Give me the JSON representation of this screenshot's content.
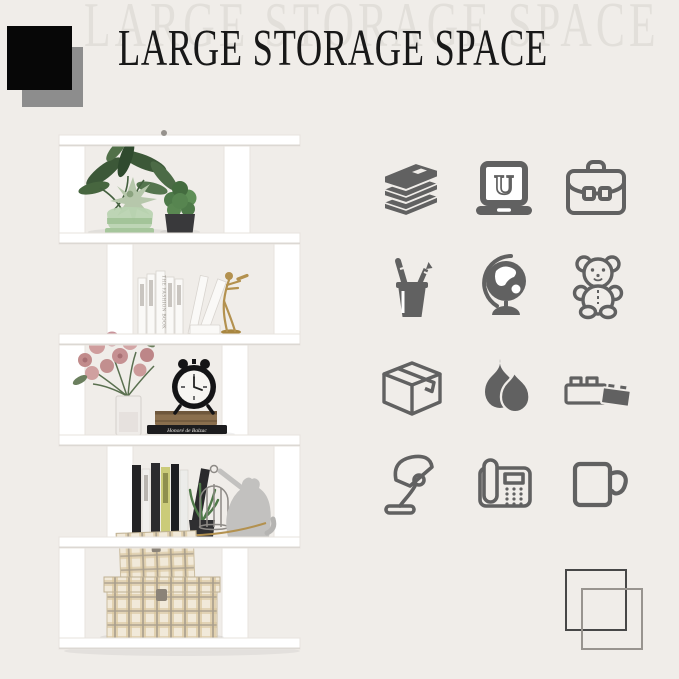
{
  "page": {
    "width": 679,
    "height": 679,
    "background": "#f0ede9"
  },
  "header": {
    "echo_title": "LARGE STORAGE SPACE",
    "title": "LARGE STORAGE SPACE",
    "title_color": "#181818",
    "echo_color": "#e2dfda",
    "black_square_color": "#070707",
    "gray_square_color": "#8d8d8d"
  },
  "photo": {
    "alt": "White 5-tier S-shaped geometric bookcase decorated with plants, white books, a gold violinist figurine, a rose bouquet, an alarm clock on stacked books, a cat figurine with birdcage, and plaid storage boxes",
    "shelf_color": "#ffffff",
    "spine_text": "THE FASHION BOOK",
    "book_text": "Honoré de Balzac"
  },
  "icons": {
    "color": "#616161",
    "laptop_letter": "U",
    "grid": [
      [
        "books-stack",
        "laptop",
        "briefcase"
      ],
      [
        "pencil-holder",
        "globe",
        "teddy-bear"
      ],
      [
        "storage-box",
        "vases",
        "lego-bricks"
      ],
      [
        "desk-lamp",
        "telephone",
        "mug"
      ]
    ]
  },
  "bottom_decor": {
    "dark_outline_color": "#474747",
    "gray_outline_color": "#98948f"
  }
}
